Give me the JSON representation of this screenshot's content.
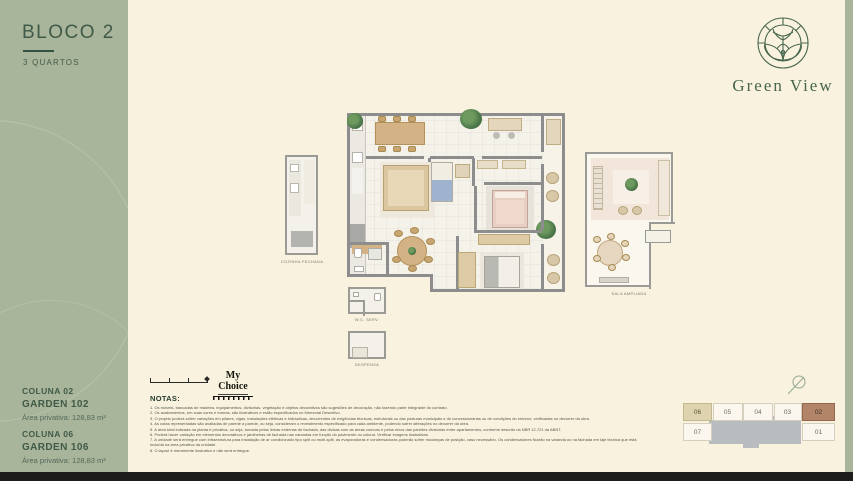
{
  "sidebar": {
    "block_title": "BLOCO 2",
    "block_subtitle": "3 QUARTOS",
    "units": [
      {
        "coluna": "COLUNA 02",
        "garden": "GARDEN 102",
        "area": "Área privativa: 128,83 m²"
      },
      {
        "coluna": "COLUNA 06",
        "garden": "GARDEN 106",
        "area": "Área privativa: 128,83 m²"
      }
    ]
  },
  "logo": {
    "name": "Green View"
  },
  "floor_plan": {
    "labels": {
      "cozinha_fechada": "COZINHA FECHADA",
      "sala_ampliada": "SALA AMPLIADA",
      "wc_serv": "W.C. SERV.",
      "despensa": "DESPENSA"
    }
  },
  "partner_logo": {
    "name": "My Choice"
  },
  "notes": {
    "heading": "NOTAS:",
    "items": [
      "1. Os móveis, bancadas de madeira, equipamentos, divisórias, vegetação e objetos decorativos são sugestões de decoração, não fazendo parte integrante do contrato.",
      "2. Os acabamentos, em suas cores e formas, são ilustrativos e estão especificados no Memorial Descritivo.",
      "3. O projeto poderá sofrer variações em pilares, vigas, instalações elétricas e hidráulicas, decorrentes de exigências técnicas, estruturais ou das posturas municipais e de concessionárias ou de condições do entorno, verificadas no decorrer da obra.",
      "4. As cotas representadas são avaliadas de parede a parede, ou seja, consideram o revestimento especificado para cada ambiente, podendo sofrer alterações no decorrer da obra.",
      "5. A área total indicada na planta é privativa, ou seja, tomada pelas linhas externas de fachada, das divisas com as áreas comuns e pelos eixos das paredes divisórias entre apartamentos, conforme descrito na NBR 12.721 da ABNT.",
      "6. Poderá haver variação em elementos decorativos e jardineiras de fachada nas varandas em função do pavimento ou coluna. Verificar imagens ilustrativas.",
      "7. A unidade será entregue com infraestrutura para instalação de ar condicionado tipo split ou multi-split, as evaporadoras e condensadoras poderão sofrer mudanças de posição, caso necessário. Os condensadores ficarão na varanda ou na fachada em laje técnica que está incluída na área privativa da unidade.",
      "8. O layout é meramente ilustrativo e não será entregue."
    ]
  },
  "keyplan": {
    "units_top": [
      "06",
      "05",
      "04",
      "03",
      "02"
    ],
    "unit_bottom_left": "07",
    "unit_bottom_right": "01",
    "highlighted_units": [
      "06",
      "02"
    ]
  },
  "colors": {
    "sidebar_green": "#a9b59a",
    "cream": "#f9f2df",
    "dark_green": "#3f5a48",
    "logo_green": "#47664e",
    "highlight_beige": "#ddd3ae",
    "highlight_brown": "#b28569",
    "keyplan_gray": "#b9bcbe",
    "bottom_bar": "#1d1d1b"
  }
}
